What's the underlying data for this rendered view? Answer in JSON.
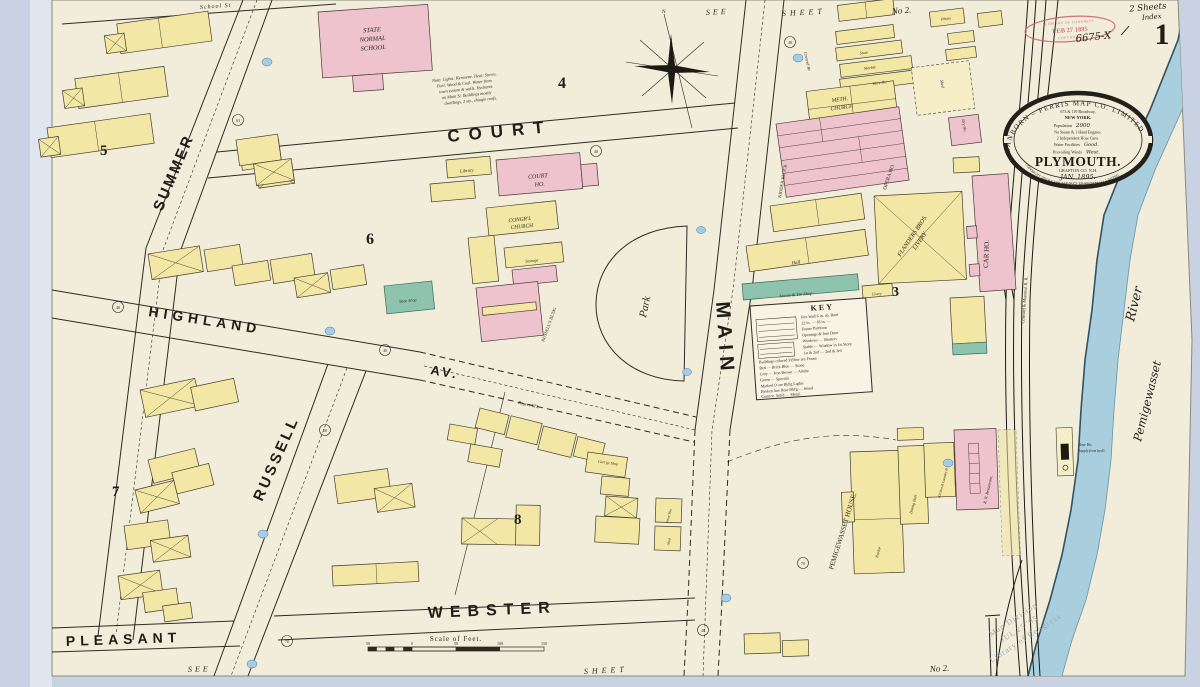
{
  "sheet": {
    "number": "1",
    "sheets_note": "2 Sheets",
    "index_note": "Index",
    "file_number": "6675-X",
    "slash": "/"
  },
  "edge": {
    "top_see": "SEE",
    "top_sheet": "SHEET",
    "top_no": "No 2.",
    "bottom_see": "SEE",
    "bottom_sheet": "SHEET",
    "bottom_no": "No 2."
  },
  "streets": {
    "summer": "SUMMER",
    "court": "COURT",
    "main": "MAIN",
    "highland": "HIGHLAND",
    "av": "AV.",
    "russell": "RUSSELL",
    "webster": "WEBSTER",
    "pleasant": "PLEASANT",
    "school": "School St",
    "covered_br": "Covered Br."
  },
  "blocks": {
    "b3": "3",
    "b4": "4",
    "b5": "5",
    "b6": "6",
    "b7": "7",
    "b8": "8"
  },
  "park": {
    "label": "Park"
  },
  "river": {
    "name": "Pemigewasset",
    "name2": "River"
  },
  "rail": {
    "company": "Concord & Montreal R. R."
  },
  "compass": {
    "north": "N"
  },
  "bldg": {
    "school_l1": "STATE",
    "school_l2": "NORMAL",
    "school_l3": "SCHOOL",
    "meth_l1": "METH.",
    "meth_l2": "CHURCH",
    "shed": "Shed",
    "dry_ho": "Dry Ho.",
    "photo": "Photo",
    "store": "Store",
    "marble": "Marble",
    "ware_ho": "Ware Ho.",
    "kidder": "KIDDER BLOCK",
    "opera": "OPERA HO.",
    "hall": "Hall",
    "stoves": "Stoves & Tin Shop",
    "livery_sm": "Livery",
    "flanders_l1": "FLANDERS BROS.",
    "flanders_l2": "LIVERY",
    "car_ho": "CAR HO.",
    "library": "Library",
    "court_l1": "COURT",
    "court_l2": "HO.",
    "congl_l1": "CONGR'L",
    "congl_l2": "CHURCH",
    "storage": "Storage",
    "russells": "RUSSELL'S BL'DG",
    "shoe": "Shoe Shop",
    "rogers": "Rogers Bl'k",
    "carr": "Carr'ge Shop",
    "paint": "Paint Sho.",
    "shed2": "Shed",
    "pemi": "PEMIGEWASSET HOUSE.",
    "parlor": "Parlor",
    "dining": "Dining Hall",
    "kitchen": "Kitchen & Laundry B.",
    "rr_rest": "R. R. Restaurant.",
    "hose_l1": "Hose Ho.",
    "hose_l2": "Supply from hyd't."
  },
  "note": {
    "l1": "Note: Lights: Kerosene. Heat: Stoves.",
    "l2": "Fuel: Wood & Coal. Water from",
    "l3": "town system & wells. Hydrants",
    "l4": "on Main St. Buildings mostly",
    "l5": "dwellings, 2 sty., shingle roofs."
  },
  "key": {
    "title": "KEY",
    "lines": [
      "Fire Wall 6 in. ab. Roof",
      "12 in. —   18 in. —",
      "Frame Partition",
      "Openings & Iron Door",
      "Windows — Shutters",
      "Stable — Window in 1st Story",
      "1st & 2nd — 2nd & 3rd",
      "Buildings colored Yellow are Frame",
      "Red — Brick     Blue — Stone",
      "Grey — Iron     Brown — Adobe",
      "Green — Specials",
      "Marked O are Bld'g Lights",
      "Broken line Rear Bld'g — Wood",
      "Cornice.   Solid — Metal."
    ]
  },
  "scalebar": {
    "label": "Scale of Feet.",
    "t1": "50",
    "t2": "0",
    "t3": "50",
    "t4": "100",
    "t5": "150"
  },
  "seal": {
    "ring_top": "SANBORN – PERRIS MAP CO. LIMITED",
    "address": "673 & 119 Broadway,",
    "city": "NEW YORK.",
    "population_label": "Population",
    "population_value": "2000",
    "engines": "No Steam & 1 Hand Engines.",
    "hose_carts": "2 Independent Hose Carts.",
    "water_label": "Water Facilities",
    "water_value": "Good.",
    "winds_label": "Prevailing Winds",
    "winds_value": "West.",
    "city_name": "PLYMOUTH.",
    "county": "GRAFTON CO. N.H.",
    "date": "JAN. 1895.",
    "scale": "SCALE 50 FT. TO AN INCH.",
    "ring_bottom": "COPYRIGHT 1895 BY THE SANBORN-PERRIS MAP CO. LIMITED."
  },
  "stamps": {
    "red_top": "LIBRARY OF CONGRESS",
    "red_date": "FEB 27 1895",
    "red_bottom": "COPYRIGHT",
    "grey_l1": "Map Division",
    "grey_l2": "JUL 25 '95",
    "grey_l3": "Library of Congress"
  },
  "markers": {
    "m1": "63",
    "m2": "40",
    "m3": "40",
    "m4": "40",
    "m5": "40",
    "m6": "50",
    "m7": "70",
    "m8": "40",
    "m9": "70"
  }
}
